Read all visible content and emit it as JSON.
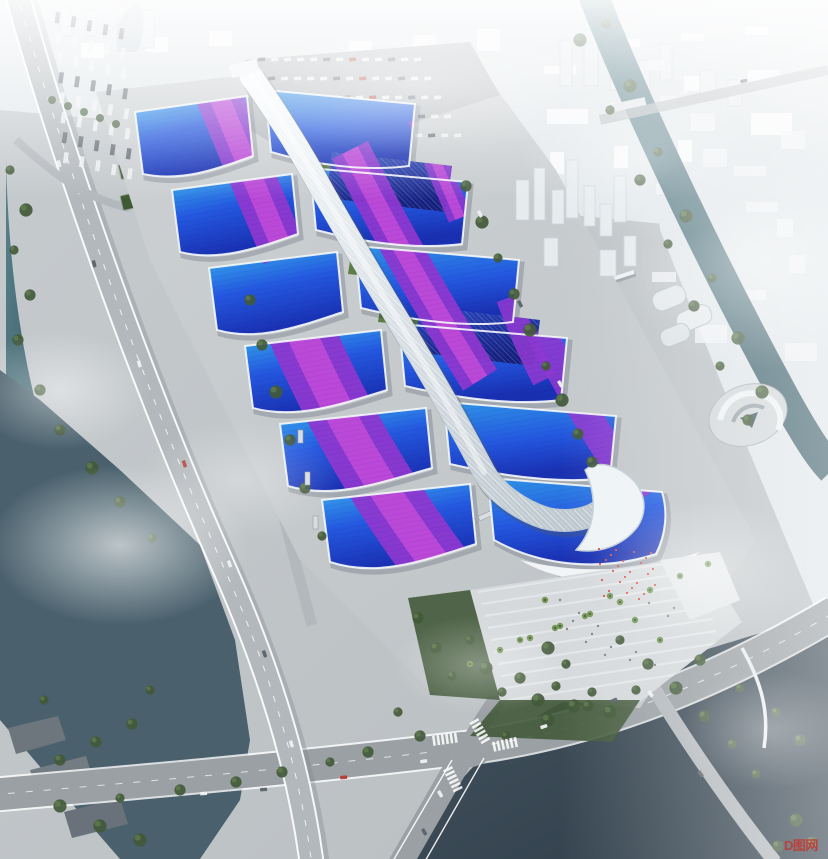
{
  "scene": {
    "type": "architectural aerial rendering",
    "description": "Bird's-eye rendering of a huge exhibition and convention center: paired wavy exhibition halls with blue gradient roofs crossed by purple ribbons, threaded by a white diagrid concourse spine ending in a sculptural south entrance shell; surrounded by aprons, parking lots, tree-lined boulevards, canals, a lake and a city fading into white fog."
  },
  "watermark": {
    "text": "D图网",
    "color": "#c5372e"
  },
  "colors": {
    "ground": "#c6cbce",
    "apron": "#cdd1d3",
    "apron2": "#c0c5c8",
    "city": "#e6ebee",
    "cityShade": "#cdd4d9",
    "fog": "#f3f6f7",
    "road": "#9aa0a4",
    "roadLight": "#b3b8bc",
    "laneLine": "#eef1f2",
    "waterTeal": "#5a828c",
    "waterTealDeep": "#3e5f6a",
    "waterDark": "#45545f",
    "waterDarker": "#2e3d49",
    "treeDark": "#42593a",
    "tree": "#567247",
    "treeLight": "#6d8a55",
    "palm": "#6f9350",
    "lawn": "#5d7d43",
    "shedRoof": "#3e5a33",
    "roofCyan": "#38b2ee",
    "roofBlue": "#2458e0",
    "roofDeep": "#1930b2",
    "roofNavy": "#2b49c4",
    "roofNavyDeep": "#141f7e",
    "ribbon": "#8d38d0",
    "ribbonBright": "#d250dc",
    "spine": "#eef3f6",
    "spineShade": "#b9c4cc",
    "fascia": "#f4f7f9",
    "plaza": "#d5d9db",
    "steps": "#e2e6e8",
    "parkRoof": "#6e777e",
    "flag": "#d84a40",
    "carWhite": "#eef1f2",
    "carDark": "#5a636a",
    "carRed": "#b23c34",
    "busBody": "#d9dde0"
  }
}
